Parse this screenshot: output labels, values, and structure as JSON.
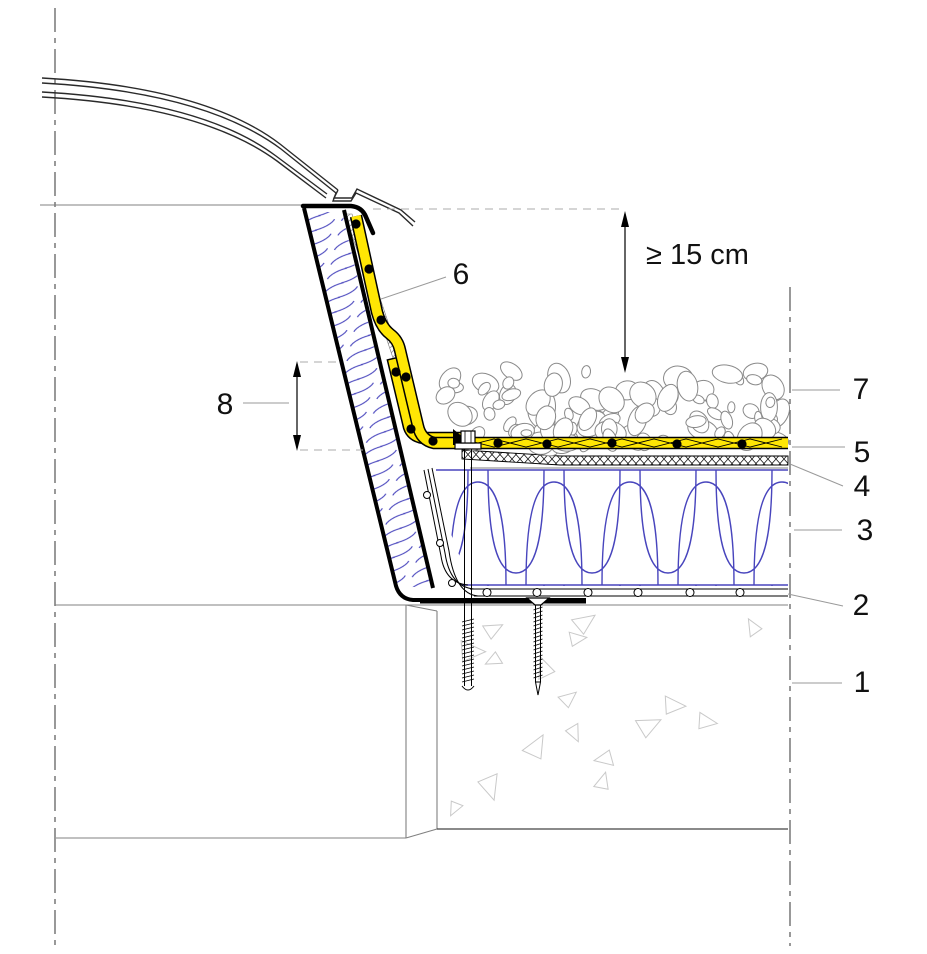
{
  "drawing": {
    "type": "construction-detail-section",
    "subject": "rooflight-dome-upstand-on-flat-roof",
    "dimension_note": "≥ 15 cm",
    "callouts": {
      "n1": "1",
      "n2": "2",
      "n3": "3",
      "n4": "4",
      "n5": "5",
      "n6": "6",
      "n7": "7",
      "n8": "8"
    }
  },
  "colors": {
    "membrane_yellow": "#ffe604",
    "insulation_blue": "#4845bd",
    "gravel_gray": "#8a8a8a",
    "concrete_aggregate_gray": "#c9c9c9",
    "line_black": "#000000"
  }
}
